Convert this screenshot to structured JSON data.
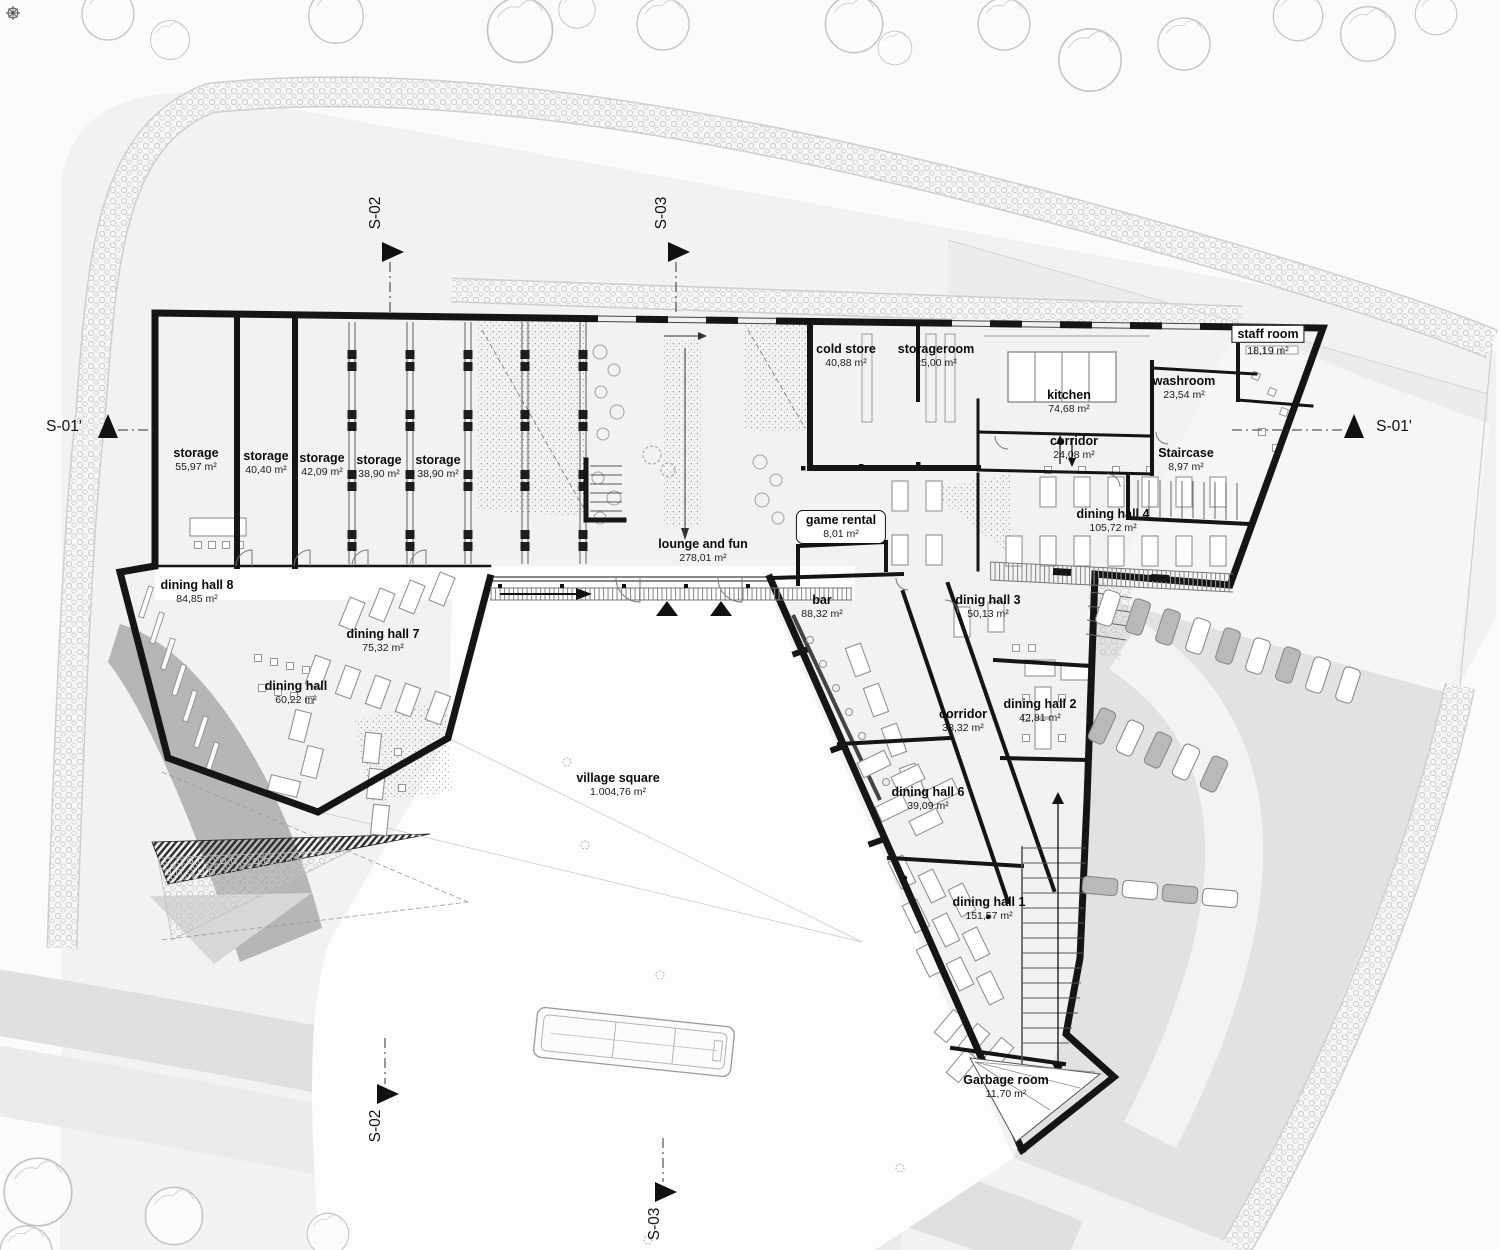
{
  "plan": {
    "rooms": [
      {
        "name": "storage",
        "area": "55,97 m²"
      },
      {
        "name": "storage",
        "area": "40,40 m²"
      },
      {
        "name": "storage",
        "area": "42,09 m²"
      },
      {
        "name": "storage",
        "area": "38,90 m²"
      },
      {
        "name": "storage",
        "area": "38,90 m²"
      },
      {
        "name": "cold store",
        "area": "40,88 m²"
      },
      {
        "name": "storageroom",
        "area": "25,00 m²"
      },
      {
        "name": "kitchen",
        "area": "74,68 m²"
      },
      {
        "name": "washroom",
        "area": "23,54 m²"
      },
      {
        "name": "staff room",
        "area": "18,19 m²"
      },
      {
        "name": "corridor",
        "area": "24,08 m²"
      },
      {
        "name": "Staircase",
        "area": "8,97 m²"
      },
      {
        "name": "dining hall 4",
        "area": "105,72 m²"
      },
      {
        "name": "game rental",
        "area": "8,01 m²"
      },
      {
        "name": "lounge and fun",
        "area": "278,01 m²"
      },
      {
        "name": "bar",
        "area": "88,32 m²"
      },
      {
        "name": "dinig hall 3",
        "area": "50,13 m²"
      },
      {
        "name": "dining hall 8",
        "area": "84,85 m²"
      },
      {
        "name": "dining hall 7",
        "area": "75,32 m²"
      },
      {
        "name": "dining hall",
        "area": "60,22 m²"
      },
      {
        "name": "corridor",
        "area": "38,32 m²"
      },
      {
        "name": "dining hall 2",
        "area": "42,81 m²"
      },
      {
        "name": "dining hall 6",
        "area": "39,09 m²"
      },
      {
        "name": "dining hall 1",
        "area": "151,57 m²"
      },
      {
        "name": "village square",
        "area": "1.004,76 m²"
      },
      {
        "name": "Garbage room",
        "area": "11,70 m²"
      }
    ],
    "sections": {
      "s01": "S-01'",
      "s02": "S-02",
      "s03": "S-03"
    }
  }
}
